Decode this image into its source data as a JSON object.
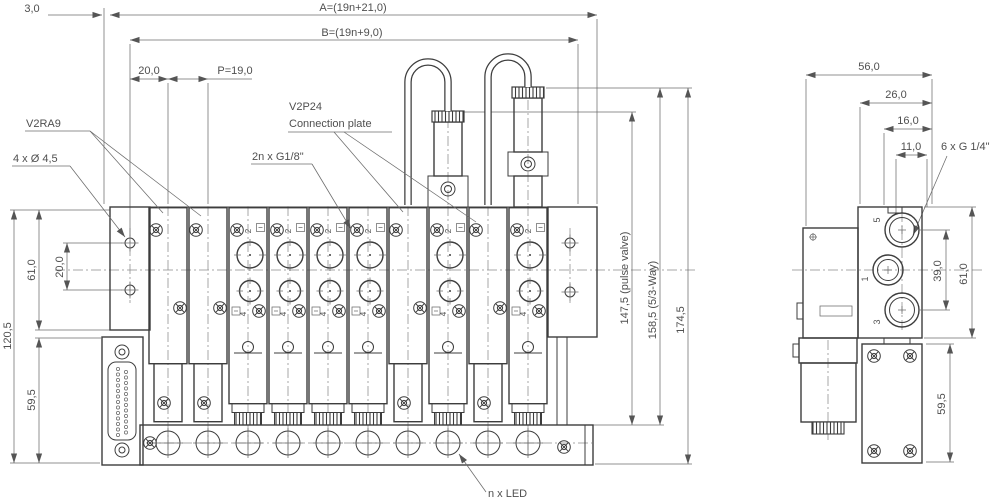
{
  "meta": {
    "drawing_type": "valve terminal dimension drawing",
    "background": "#ffffff",
    "line_color": "#3d3d3d",
    "dim_color": "#6b6b6b",
    "text_color": "#4f4f4f"
  },
  "front_view": {
    "dims": {
      "offset_3": "3,0",
      "length_a": "A=(19n+21,0)",
      "length_b": "B=(19n+9,0)",
      "hole_to_station": "20,0",
      "pitch": "P=19,0",
      "rail_height": "61,0",
      "hole_spacing": "20,0",
      "body_height": "120,5",
      "connector_height": "59,5",
      "pulse_valve_height": "147,5 (pulse valve)",
      "way_53_height": "158,5 (5/3-Way)",
      "total_height": "174,5"
    },
    "callouts": {
      "blanking_plate": "V2RA9",
      "mounting_holes": "4 x Ø 4,5",
      "working_ports": "2n x G1/8\"",
      "connection_plate_l1": "V2P24",
      "connection_plate_l2": "Connection plate",
      "led": "n x LED"
    },
    "station_labels": {
      "port_top": "2",
      "port_bottom": "4"
    }
  },
  "side_view": {
    "dims": {
      "depth": "56,0",
      "d26": "26,0",
      "d16": "16,0",
      "d11": "11,0",
      "port_spacing": "39,0",
      "block_height": "61,0",
      "base_height": "59,5"
    },
    "callouts": {
      "supply_ports": "6 x G 1/4\""
    },
    "port_labels": {
      "top": "5",
      "middle": "1",
      "bottom": "3"
    }
  }
}
